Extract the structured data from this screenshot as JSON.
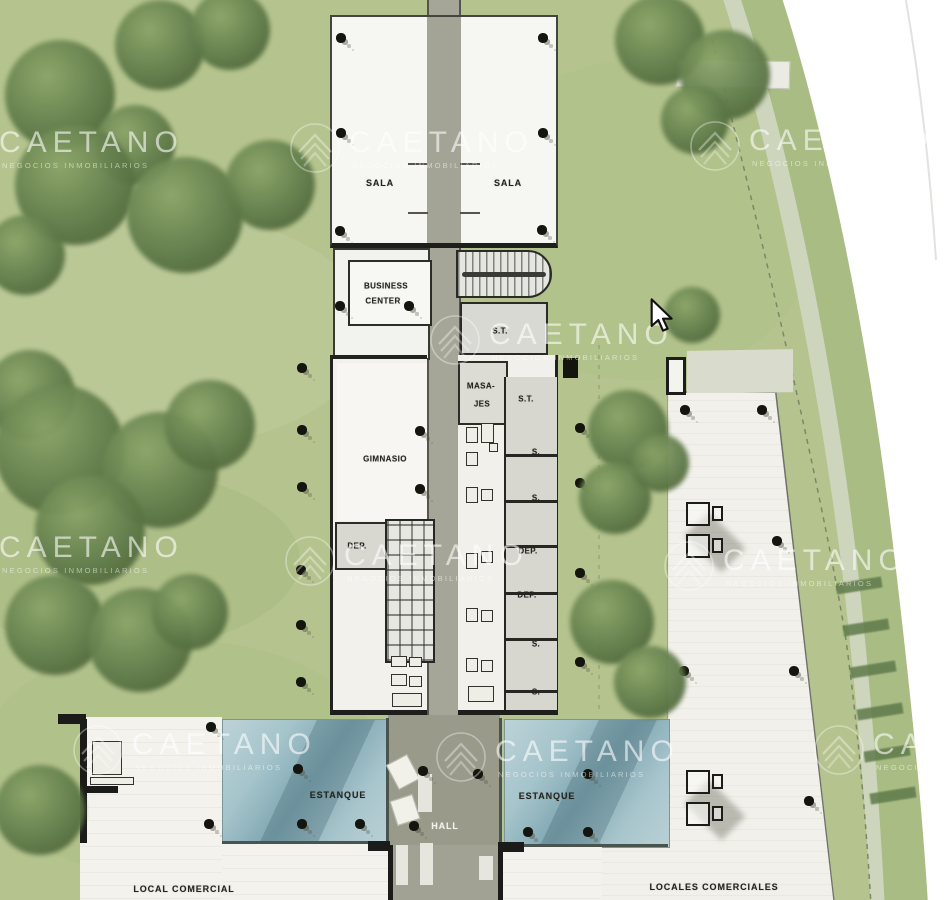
{
  "colors": {
    "grass": "#b5c48e",
    "tree": "#5c7748",
    "water": "#9dbec7",
    "path": "#a6a698",
    "wall": "#1e1e1c",
    "floor": "#f3f2ed",
    "room_gray": "#d8d8d1",
    "outside_white": "#ffffff",
    "road": "#ccd4ba"
  },
  "watermark": {
    "brand": "CAETANO",
    "sub": "NEGOCIOS INMOBILIARIOS",
    "instances": [
      {
        "x": -62,
        "y": 118
      },
      {
        "x": 288,
        "y": 118
      },
      {
        "x": 688,
        "y": 116
      },
      {
        "x": 428,
        "y": 310
      },
      {
        "x": -62,
        "y": 523
      },
      {
        "x": 283,
        "y": 531
      },
      {
        "x": 662,
        "y": 536
      },
      {
        "x": 71,
        "y": 720
      },
      {
        "x": 434,
        "y": 727
      },
      {
        "x": 812,
        "y": 720
      }
    ]
  },
  "plan_labels": [
    {
      "text": "SALA",
      "x": 380,
      "y": 183,
      "cls": "lg"
    },
    {
      "text": "SALA",
      "x": 508,
      "y": 183,
      "cls": "lg"
    },
    {
      "text": "BUSINESS",
      "x": 386,
      "y": 286,
      "cls": ""
    },
    {
      "text": "CENTER",
      "x": 383,
      "y": 301,
      "cls": ""
    },
    {
      "text": "S.T.",
      "x": 500,
      "y": 331,
      "cls": ""
    },
    {
      "text": "MASA-",
      "x": 481,
      "y": 386,
      "cls": ""
    },
    {
      "text": "JES",
      "x": 482,
      "y": 404,
      "cls": ""
    },
    {
      "text": "S.T.",
      "x": 526,
      "y": 399,
      "cls": ""
    },
    {
      "text": "GIMNASIO",
      "x": 385,
      "y": 459,
      "cls": ""
    },
    {
      "text": "S.",
      "x": 536,
      "y": 452,
      "cls": ""
    },
    {
      "text": "S.",
      "x": 536,
      "y": 498,
      "cls": ""
    },
    {
      "text": "DEP.",
      "x": 357,
      "y": 546,
      "cls": ""
    },
    {
      "text": "DEP.",
      "x": 528,
      "y": 551,
      "cls": ""
    },
    {
      "text": "DEP.",
      "x": 527,
      "y": 595,
      "cls": ""
    },
    {
      "text": "S.",
      "x": 536,
      "y": 644,
      "cls": ""
    },
    {
      "text": "S.",
      "x": 536,
      "y": 692,
      "cls": ""
    },
    {
      "text": "ESTANQUE",
      "x": 338,
      "y": 795,
      "cls": "lg"
    },
    {
      "text": "ESTANQUE",
      "x": 547,
      "y": 796,
      "cls": "lg"
    },
    {
      "text": "HALL",
      "x": 445,
      "y": 826,
      "cls": "lg white"
    },
    {
      "text": "LOCAL COMERCIAL",
      "x": 184,
      "y": 889,
      "cls": "lg"
    },
    {
      "text": "LOCALES COMERCIALES",
      "x": 714,
      "y": 887,
      "cls": "lg"
    }
  ],
  "columns": [
    {
      "x": 341,
      "y": 38
    },
    {
      "x": 543,
      "y": 38
    },
    {
      "x": 341,
      "y": 133
    },
    {
      "x": 543,
      "y": 133
    },
    {
      "x": 340,
      "y": 231
    },
    {
      "x": 542,
      "y": 230
    },
    {
      "x": 340,
      "y": 306
    },
    {
      "x": 409,
      "y": 306
    },
    {
      "x": 420,
      "y": 431
    },
    {
      "x": 420,
      "y": 489
    },
    {
      "x": 302,
      "y": 368
    },
    {
      "x": 302,
      "y": 430
    },
    {
      "x": 302,
      "y": 487
    },
    {
      "x": 301,
      "y": 570
    },
    {
      "x": 301,
      "y": 625
    },
    {
      "x": 301,
      "y": 682
    },
    {
      "x": 580,
      "y": 428
    },
    {
      "x": 580,
      "y": 483
    },
    {
      "x": 580,
      "y": 573
    },
    {
      "x": 580,
      "y": 662
    },
    {
      "x": 211,
      "y": 727
    },
    {
      "x": 209,
      "y": 824
    },
    {
      "x": 298,
      "y": 769
    },
    {
      "x": 302,
      "y": 824
    },
    {
      "x": 360,
      "y": 824
    },
    {
      "x": 414,
      "y": 826
    },
    {
      "x": 423,
      "y": 771
    },
    {
      "x": 478,
      "y": 774
    },
    {
      "x": 528,
      "y": 832
    },
    {
      "x": 588,
      "y": 774
    },
    {
      "x": 588,
      "y": 832
    },
    {
      "x": 685,
      "y": 410
    },
    {
      "x": 762,
      "y": 410
    },
    {
      "x": 777,
      "y": 541
    },
    {
      "x": 684,
      "y": 671
    },
    {
      "x": 794,
      "y": 671
    },
    {
      "x": 809,
      "y": 801
    }
  ],
  "trees": [
    {
      "x": 60,
      "y": 95,
      "r": 55
    },
    {
      "x": 160,
      "y": 45,
      "r": 45
    },
    {
      "x": 230,
      "y": 30,
      "r": 40
    },
    {
      "x": 135,
      "y": 145,
      "r": 40
    },
    {
      "x": 75,
      "y": 185,
      "r": 60
    },
    {
      "x": 185,
      "y": 215,
      "r": 58
    },
    {
      "x": 270,
      "y": 185,
      "r": 45
    },
    {
      "x": 25,
      "y": 255,
      "r": 40
    },
    {
      "x": 30,
      "y": 395,
      "r": 45
    },
    {
      "x": 60,
      "y": 450,
      "r": 65
    },
    {
      "x": 160,
      "y": 470,
      "r": 58
    },
    {
      "x": 90,
      "y": 530,
      "r": 55
    },
    {
      "x": 210,
      "y": 425,
      "r": 45
    },
    {
      "x": 55,
      "y": 625,
      "r": 50
    },
    {
      "x": 140,
      "y": 640,
      "r": 52
    },
    {
      "x": 190,
      "y": 612,
      "r": 38
    },
    {
      "x": 40,
      "y": 810,
      "r": 45
    },
    {
      "x": 628,
      "y": 430,
      "r": 40
    },
    {
      "x": 615,
      "y": 498,
      "r": 36
    },
    {
      "x": 660,
      "y": 463,
      "r": 29
    },
    {
      "x": 612,
      "y": 622,
      "r": 42
    },
    {
      "x": 650,
      "y": 682,
      "r": 36
    },
    {
      "x": 692,
      "y": 315,
      "r": 28
    },
    {
      "x": 660,
      "y": 40,
      "r": 45
    },
    {
      "x": 725,
      "y": 75,
      "r": 45
    },
    {
      "x": 695,
      "y": 120,
      "r": 34
    }
  ],
  "fixtures": [
    {
      "x": 466,
      "y": 427,
      "w": 12,
      "h": 16
    },
    {
      "x": 481,
      "y": 423,
      "w": 13,
      "h": 20
    },
    {
      "x": 466,
      "y": 452,
      "w": 12,
      "h": 14
    },
    {
      "x": 489,
      "y": 443,
      "w": 9,
      "h": 9
    },
    {
      "x": 466,
      "y": 487,
      "w": 12,
      "h": 16
    },
    {
      "x": 481,
      "y": 489,
      "w": 12,
      "h": 12
    },
    {
      "x": 466,
      "y": 553,
      "w": 12,
      "h": 16
    },
    {
      "x": 481,
      "y": 551,
      "w": 12,
      "h": 12
    },
    {
      "x": 466,
      "y": 608,
      "w": 12,
      "h": 14
    },
    {
      "x": 481,
      "y": 610,
      "w": 12,
      "h": 12
    },
    {
      "x": 466,
      "y": 658,
      "w": 12,
      "h": 14
    },
    {
      "x": 481,
      "y": 660,
      "w": 12,
      "h": 12
    },
    {
      "x": 468,
      "y": 686,
      "w": 26,
      "h": 16
    },
    {
      "x": 391,
      "y": 656,
      "w": 16,
      "h": 11
    },
    {
      "x": 409,
      "y": 657,
      "w": 13,
      "h": 10
    },
    {
      "x": 391,
      "y": 674,
      "w": 16,
      "h": 12
    },
    {
      "x": 409,
      "y": 676,
      "w": 13,
      "h": 11
    },
    {
      "x": 392,
      "y": 693,
      "w": 30,
      "h": 14
    },
    {
      "x": 92,
      "y": 741,
      "w": 30,
      "h": 34
    },
    {
      "x": 90,
      "y": 777,
      "w": 44,
      "h": 8
    }
  ],
  "hedges": [
    {
      "x": 836,
      "y": 580
    },
    {
      "x": 843,
      "y": 622
    },
    {
      "x": 850,
      "y": 664
    },
    {
      "x": 857,
      "y": 706
    },
    {
      "x": 864,
      "y": 748
    },
    {
      "x": 870,
      "y": 790
    }
  ],
  "room_dividers_y": [
    77,
    123,
    168,
    215,
    261,
    313
  ],
  "icons": {
    "cursor": "mouse-cursor",
    "logo": "caetano-roof-logo"
  }
}
